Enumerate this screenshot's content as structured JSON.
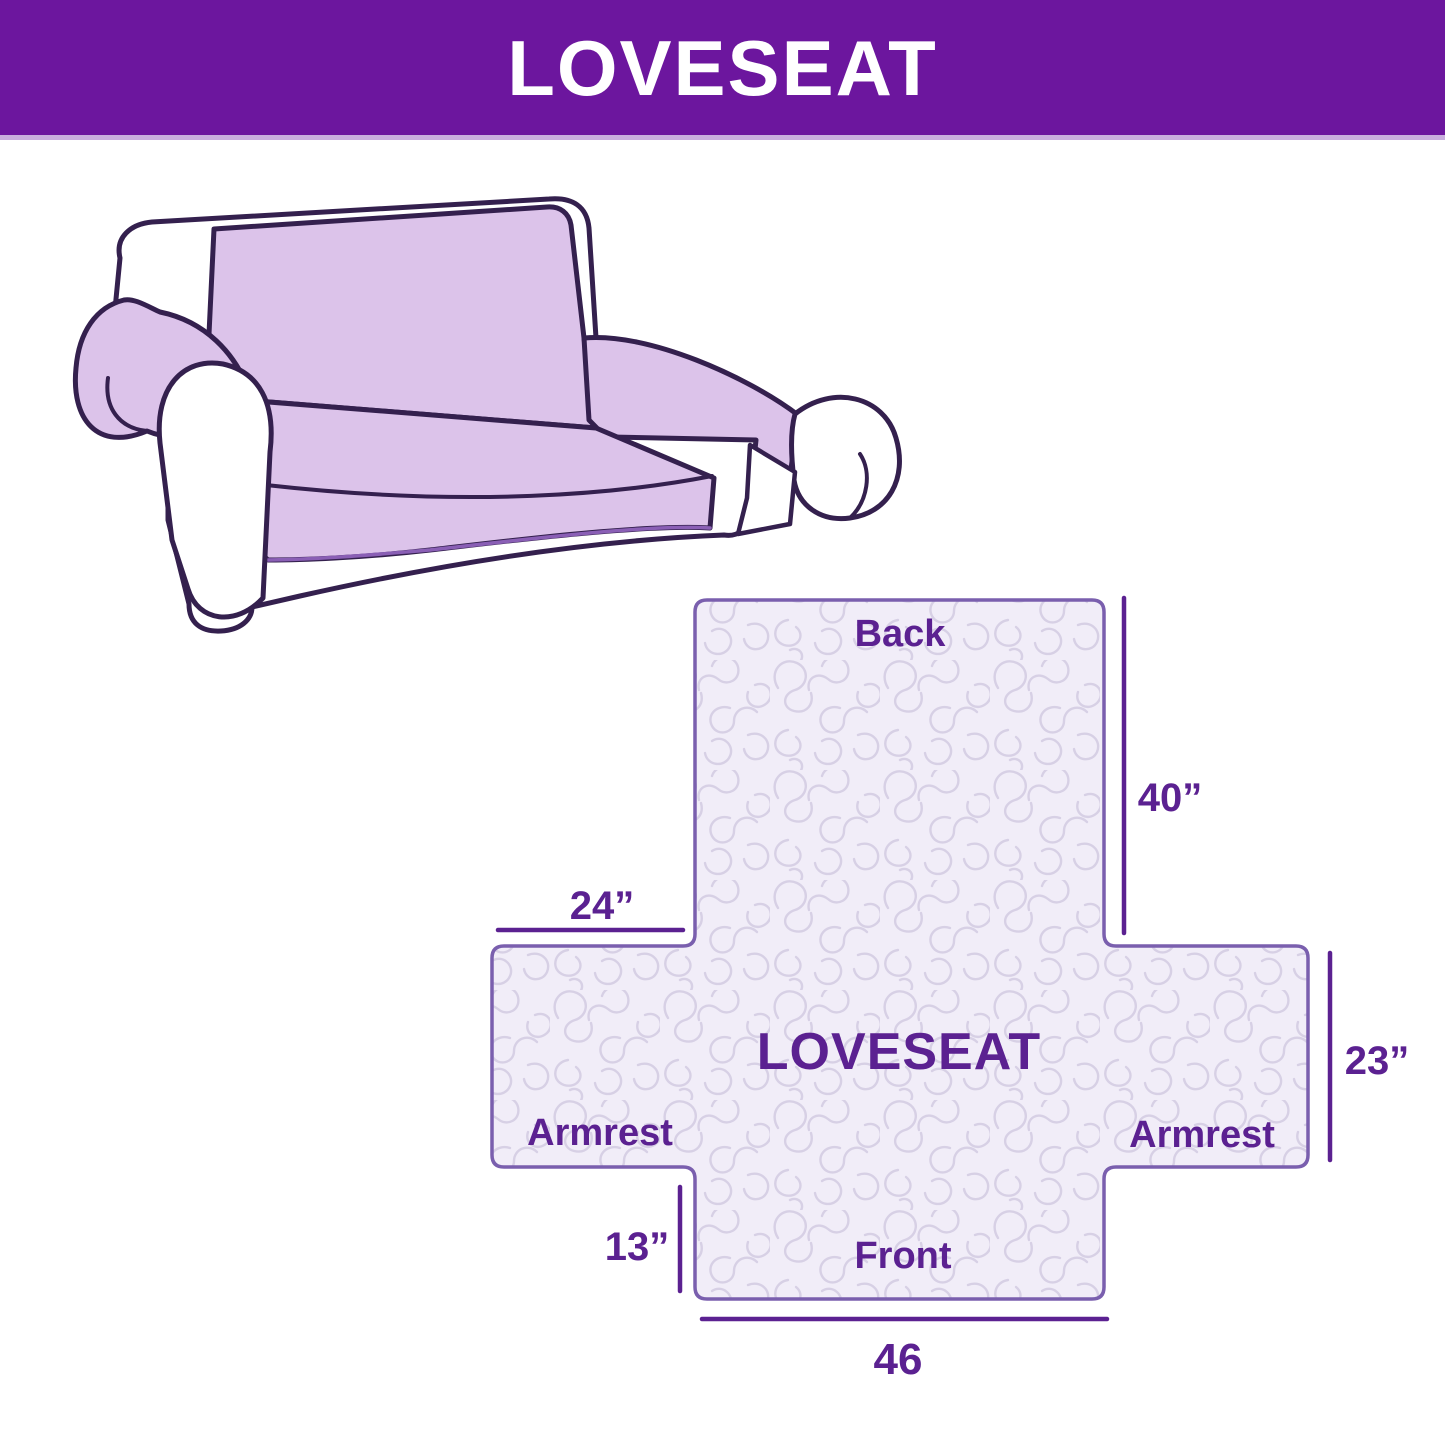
{
  "header": {
    "title": "LOVESEAT",
    "background_color": "#6c169e",
    "text_color": "#ffffff"
  },
  "sofa_illustration": {
    "description": "Line drawing of a two-seat loveseat with a light purple slipcover on back, seat and arms",
    "cover_color": "#dcc3ea",
    "outline_color": "#34204e"
  },
  "cover_diagram": {
    "center_label": "LOVESEAT",
    "back_label": "Back",
    "front_label": "Front",
    "armrest_left_label": "Armrest",
    "armrest_right_label": "Armrest",
    "dimensions": {
      "back_length": "40”",
      "armrest_width": "24”",
      "armrest_depth": "23”",
      "front_drop": "13”",
      "front_width": "46"
    },
    "colors": {
      "fill": "#f1edf8",
      "quilting_pattern": "#d7d0e5",
      "outline": "#7a5fae",
      "text": "#5b2191"
    }
  }
}
